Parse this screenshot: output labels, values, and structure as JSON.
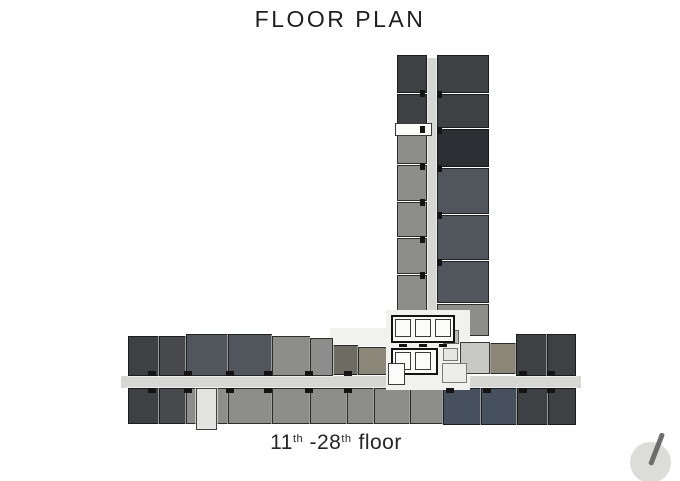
{
  "page": {
    "title": "FLOOR PLAN",
    "background": "#ffffff"
  },
  "caption": {
    "p1": "11",
    "sup1": "th",
    "p2": " -28",
    "sup2": "th",
    "p3": "floor"
  },
  "compass": {
    "name": "north-indicator",
    "circle_color": "#dcdcda",
    "needle_color": "#6d6d6d"
  },
  "plan": {
    "palette": {
      "corridor": "#d6d6d4",
      "coreWhite": "#f1f1ef",
      "white": "#fbfbfa",
      "charcoal": "#3e4043",
      "charcoal2": "#47494d",
      "charcoalDark": "#2c2f33",
      "slate": "#51565c",
      "slateBlue": "#46515d",
      "gray": "#8d8d8b",
      "grayLight": "#c8c8c4",
      "olive": "#8a8778",
      "oliveDark": "#6c6c63",
      "stairLight": "#e3e3e1",
      "utilLight": "#ededeb",
      "utilMid": "#e5e5e3",
      "utilGray": "#b9b9b6"
    },
    "rects": [
      {
        "name": "tower-corridor",
        "x": 425,
        "y": 58,
        "w": 12,
        "h": 320,
        "c": "corridor",
        "cls": "plain"
      },
      {
        "name": "wing-corridor",
        "x": 121,
        "y": 376,
        "w": 460,
        "h": 12,
        "c": "corridor",
        "cls": "plain"
      },
      {
        "name": "tower-unit",
        "x": 397,
        "y": 55,
        "w": 30,
        "h": 38,
        "c": "charcoal",
        "cls": "unit"
      },
      {
        "name": "tower-unit",
        "x": 397,
        "y": 94,
        "w": 30,
        "h": 34,
        "c": "charcoal",
        "cls": "unit"
      },
      {
        "name": "tower-unit",
        "x": 397,
        "y": 129,
        "w": 30,
        "h": 35,
        "c": "gray",
        "cls": "unit"
      },
      {
        "name": "tower-unit",
        "x": 397,
        "y": 165,
        "w": 30,
        "h": 36,
        "c": "gray",
        "cls": "unit"
      },
      {
        "name": "tower-unit",
        "x": 397,
        "y": 202,
        "w": 30,
        "h": 35,
        "c": "gray",
        "cls": "unit"
      },
      {
        "name": "tower-unit",
        "x": 397,
        "y": 238,
        "w": 30,
        "h": 36,
        "c": "gray",
        "cls": "unit"
      },
      {
        "name": "tower-unit",
        "x": 397,
        "y": 275,
        "w": 30,
        "h": 36,
        "c": "gray",
        "cls": "unit"
      },
      {
        "name": "tower-unit",
        "x": 397,
        "y": 312,
        "w": 30,
        "h": 22,
        "c": "gray",
        "cls": "unit"
      },
      {
        "name": "tower-unit",
        "x": 437,
        "y": 55,
        "w": 52,
        "h": 38,
        "c": "charcoal",
        "cls": "unit"
      },
      {
        "name": "tower-unit",
        "x": 437,
        "y": 94,
        "w": 52,
        "h": 34,
        "c": "charcoal",
        "cls": "unit"
      },
      {
        "name": "tower-unit",
        "x": 437,
        "y": 129,
        "w": 52,
        "h": 38,
        "c": "charcoalDark",
        "cls": "unit"
      },
      {
        "name": "tower-unit",
        "x": 437,
        "y": 168,
        "w": 52,
        "h": 46,
        "c": "slate",
        "cls": "unit"
      },
      {
        "name": "tower-unit",
        "x": 437,
        "y": 215,
        "w": 52,
        "h": 45,
        "c": "slate",
        "cls": "unit"
      },
      {
        "name": "tower-unit",
        "x": 437,
        "y": 261,
        "w": 52,
        "h": 42,
        "c": "slate",
        "cls": "unit"
      },
      {
        "name": "tower-unit",
        "x": 437,
        "y": 304,
        "w": 52,
        "h": 32,
        "c": "gray",
        "cls": "unit"
      },
      {
        "name": "tower-label-box",
        "x": 395,
        "y": 123,
        "w": 37,
        "h": 13,
        "c": "white",
        "cls": "outlined-thin"
      },
      {
        "name": "core-floor-left",
        "x": 330,
        "y": 328,
        "w": 58,
        "h": 18,
        "c": "coreWhite",
        "cls": "plain"
      },
      {
        "name": "wing-unit",
        "x": 332,
        "y": 345,
        "w": 26,
        "h": 30,
        "c": "oliveDark",
        "cls": "unit"
      },
      {
        "name": "wing-unit",
        "x": 358,
        "y": 347,
        "w": 31,
        "h": 28,
        "c": "olive",
        "cls": "unit"
      },
      {
        "name": "wing-unit",
        "x": 128,
        "y": 336,
        "w": 31,
        "h": 40,
        "c": "charcoal",
        "cls": "unit"
      },
      {
        "name": "wing-unit",
        "x": 159,
        "y": 336,
        "w": 27,
        "h": 40,
        "c": "charcoal2",
        "cls": "unit"
      },
      {
        "name": "wing-unit",
        "x": 186,
        "y": 334,
        "w": 42,
        "h": 42,
        "c": "slate",
        "cls": "unit"
      },
      {
        "name": "wing-unit",
        "x": 228,
        "y": 334,
        "w": 44,
        "h": 42,
        "c": "slate",
        "cls": "unit"
      },
      {
        "name": "wing-unit",
        "x": 272,
        "y": 336,
        "w": 38,
        "h": 40,
        "c": "gray",
        "cls": "unit"
      },
      {
        "name": "wing-unit",
        "x": 310,
        "y": 338,
        "w": 23,
        "h": 38,
        "c": "gray",
        "cls": "unit"
      },
      {
        "name": "wing-unit",
        "x": 490,
        "y": 343,
        "w": 26,
        "h": 31,
        "c": "olive",
        "cls": "unit"
      },
      {
        "name": "wing-unit",
        "x": 516,
        "y": 334,
        "w": 31,
        "h": 42,
        "c": "charcoal",
        "cls": "unit"
      },
      {
        "name": "wing-unit",
        "x": 547,
        "y": 334,
        "w": 29,
        "h": 42,
        "c": "charcoal",
        "cls": "unit"
      },
      {
        "name": "wing-unit",
        "x": 128,
        "y": 388,
        "w": 31,
        "h": 36,
        "c": "charcoal",
        "cls": "unit"
      },
      {
        "name": "wing-unit",
        "x": 159,
        "y": 388,
        "w": 27,
        "h": 36,
        "c": "charcoal2",
        "cls": "unit"
      },
      {
        "name": "wing-unit",
        "x": 186,
        "y": 388,
        "w": 42,
        "h": 36,
        "c": "gray",
        "cls": "unit"
      },
      {
        "name": "wing-unit",
        "x": 228,
        "y": 388,
        "w": 44,
        "h": 36,
        "c": "gray",
        "cls": "unit"
      },
      {
        "name": "wing-unit",
        "x": 272,
        "y": 388,
        "w": 38,
        "h": 36,
        "c": "gray",
        "cls": "unit"
      },
      {
        "name": "wing-unit",
        "x": 310,
        "y": 388,
        "w": 37,
        "h": 36,
        "c": "gray",
        "cls": "unit"
      },
      {
        "name": "wing-unit",
        "x": 347,
        "y": 388,
        "w": 27,
        "h": 36,
        "c": "gray",
        "cls": "unit"
      },
      {
        "name": "wing-unit",
        "x": 374,
        "y": 388,
        "w": 36,
        "h": 36,
        "c": "gray",
        "cls": "unit"
      },
      {
        "name": "wing-unit",
        "x": 410,
        "y": 388,
        "w": 33,
        "h": 36,
        "c": "gray",
        "cls": "unit"
      },
      {
        "name": "wing-unit",
        "x": 443,
        "y": 388,
        "w": 38,
        "h": 37,
        "c": "slateBlue",
        "cls": "unit"
      },
      {
        "name": "wing-unit",
        "x": 481,
        "y": 388,
        "w": 36,
        "h": 37,
        "c": "slateBlue",
        "cls": "unit"
      },
      {
        "name": "wing-unit",
        "x": 517,
        "y": 388,
        "w": 31,
        "h": 37,
        "c": "charcoal",
        "cls": "unit"
      },
      {
        "name": "wing-unit",
        "x": 548,
        "y": 388,
        "w": 28,
        "h": 37,
        "c": "charcoal",
        "cls": "unit"
      },
      {
        "name": "stair-exit",
        "x": 196,
        "y": 388,
        "w": 21,
        "h": 42,
        "c": "stairLight",
        "cls": "unit"
      },
      {
        "name": "core-floor",
        "x": 386,
        "y": 310,
        "w": 84,
        "h": 80,
        "c": "coreWhite",
        "cls": "plain"
      },
      {
        "name": "utility-cell",
        "x": 443,
        "y": 330,
        "w": 16,
        "h": 14,
        "c": "utilGray",
        "cls": "unit-thin"
      },
      {
        "name": "junction-cell",
        "x": 460,
        "y": 342,
        "w": 30,
        "h": 32,
        "c": "grayLight",
        "cls": "unit"
      },
      {
        "name": "lift-bank",
        "x": 391,
        "y": 315,
        "w": 64,
        "h": 28,
        "c": "white",
        "cls": "outlined"
      },
      {
        "name": "lift-cell",
        "x": 395,
        "y": 319,
        "w": 16,
        "h": 18,
        "c": "white",
        "cls": "outlined-thin"
      },
      {
        "name": "lift-cell",
        "x": 415,
        "y": 319,
        "w": 16,
        "h": 18,
        "c": "white",
        "cls": "outlined-thin"
      },
      {
        "name": "lift-cell",
        "x": 435,
        "y": 319,
        "w": 16,
        "h": 18,
        "c": "white",
        "cls": "outlined-thin"
      },
      {
        "name": "lift-bank",
        "x": 391,
        "y": 348,
        "w": 47,
        "h": 27,
        "c": "white",
        "cls": "outlined"
      },
      {
        "name": "lift-cell",
        "x": 395,
        "y": 352,
        "w": 16,
        "h": 18,
        "c": "white",
        "cls": "outlined-thin"
      },
      {
        "name": "lift-cell",
        "x": 415,
        "y": 352,
        "w": 16,
        "h": 18,
        "c": "white",
        "cls": "outlined-thin"
      },
      {
        "name": "fireman-lift-box",
        "x": 388,
        "y": 363,
        "w": 17,
        "h": 22,
        "c": "white",
        "cls": "outlined-thin"
      },
      {
        "name": "utility-cell",
        "x": 443,
        "y": 348,
        "w": 15,
        "h": 13,
        "c": "utilMid",
        "cls": "unit-thin"
      },
      {
        "name": "utility-cell",
        "x": 442,
        "y": 363,
        "w": 25,
        "h": 20,
        "c": "utilLight",
        "cls": "unit-thin"
      }
    ],
    "ticks": [
      {
        "x": 420,
        "y": 90,
        "w": 5,
        "h": 7
      },
      {
        "x": 420,
        "y": 126,
        "w": 5,
        "h": 7
      },
      {
        "x": 420,
        "y": 163,
        "w": 5,
        "h": 7
      },
      {
        "x": 420,
        "y": 199,
        "w": 5,
        "h": 7
      },
      {
        "x": 420,
        "y": 236,
        "w": 5,
        "h": 7
      },
      {
        "x": 420,
        "y": 272,
        "w": 5,
        "h": 7
      },
      {
        "x": 437,
        "y": 91,
        "w": 5,
        "h": 7
      },
      {
        "x": 437,
        "y": 127,
        "w": 5,
        "h": 7
      },
      {
        "x": 437,
        "y": 165,
        "w": 5,
        "h": 7
      },
      {
        "x": 437,
        "y": 212,
        "w": 5,
        "h": 7
      },
      {
        "x": 437,
        "y": 259,
        "w": 5,
        "h": 7
      },
      {
        "x": 399,
        "y": 344,
        "w": 8,
        "h": 3
      },
      {
        "x": 419,
        "y": 344,
        "w": 8,
        "h": 3
      },
      {
        "x": 439,
        "y": 344,
        "w": 8,
        "h": 3
      },
      {
        "x": 148,
        "y": 371,
        "w": 8,
        "h": 5
      },
      {
        "x": 184,
        "y": 371,
        "w": 8,
        "h": 5
      },
      {
        "x": 226,
        "y": 371,
        "w": 8,
        "h": 5
      },
      {
        "x": 264,
        "y": 371,
        "w": 8,
        "h": 5
      },
      {
        "x": 305,
        "y": 371,
        "w": 8,
        "h": 5
      },
      {
        "x": 344,
        "y": 371,
        "w": 8,
        "h": 5
      },
      {
        "x": 519,
        "y": 371,
        "w": 8,
        "h": 5
      },
      {
        "x": 547,
        "y": 371,
        "w": 8,
        "h": 5
      },
      {
        "x": 148,
        "y": 388,
        "w": 8,
        "h": 5
      },
      {
        "x": 184,
        "y": 388,
        "w": 8,
        "h": 5
      },
      {
        "x": 226,
        "y": 388,
        "w": 8,
        "h": 5
      },
      {
        "x": 264,
        "y": 388,
        "w": 8,
        "h": 5
      },
      {
        "x": 305,
        "y": 388,
        "w": 8,
        "h": 5
      },
      {
        "x": 344,
        "y": 388,
        "w": 8,
        "h": 5
      },
      {
        "x": 446,
        "y": 388,
        "w": 8,
        "h": 5
      },
      {
        "x": 483,
        "y": 388,
        "w": 8,
        "h": 5
      },
      {
        "x": 519,
        "y": 388,
        "w": 8,
        "h": 5
      },
      {
        "x": 547,
        "y": 388,
        "w": 8,
        "h": 5
      }
    ]
  }
}
